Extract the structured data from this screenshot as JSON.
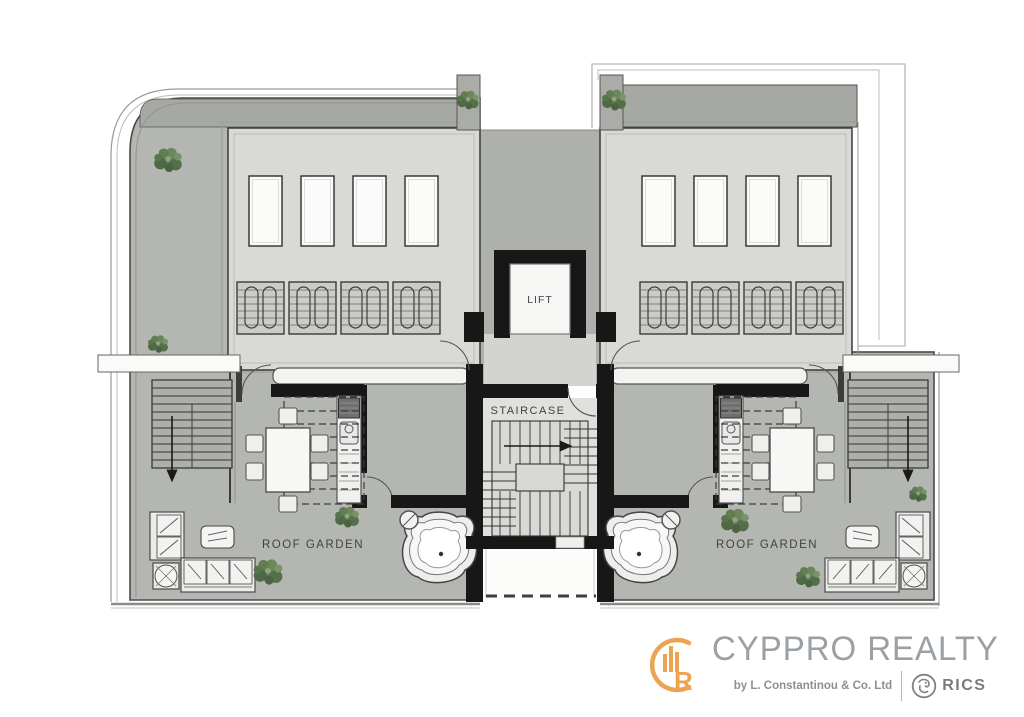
{
  "window": {
    "background": "#ffffff"
  },
  "plan": {
    "lift_label": "LIFT",
    "staircase_label": "STAIRCASE",
    "left_roof_garden_label": "ROOF GARDEN",
    "right_roof_garden_label": "ROOF GARDEN",
    "colors": {
      "deck": "#b4b7b1",
      "top_strip": "#a6a9a3",
      "roof_slab": "#d9dad5",
      "corridor": "#adb0ab",
      "wall": "#171717",
      "stair_room": "#e0e0dc",
      "plant_green": "#5e7750"
    }
  },
  "logo": {
    "icon_letter": "R",
    "name": "CYPPRO REALTY",
    "byline": "by L. Constantinou & Co. Ltd",
    "membership": "RICS",
    "accent_color": "#ECA452",
    "text_color": "#9ba0a5"
  }
}
